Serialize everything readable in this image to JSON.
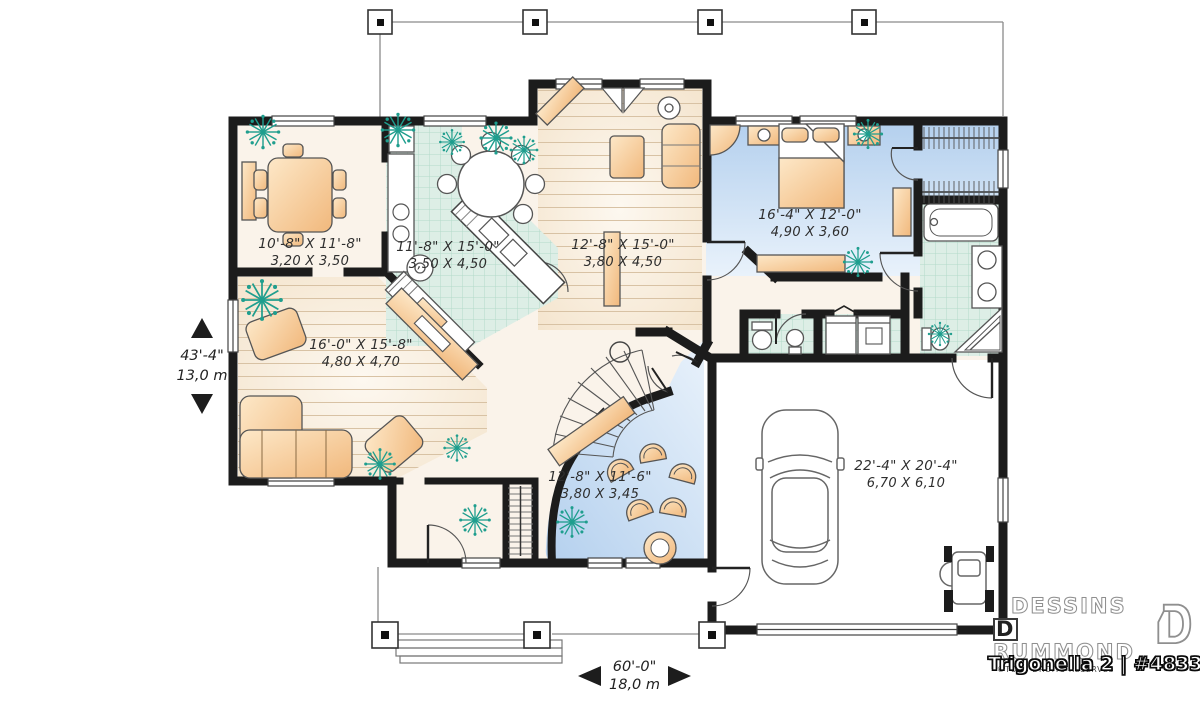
{
  "brand": {
    "line1": "DESSINS",
    "line2_initial": "D",
    "line2_rest": "RUMMOND",
    "copyright": "©TOUS DROITS RÉSERVÉS",
    "plan_title": "Trigonella 2 | #4833"
  },
  "overall_dimensions": {
    "width_imperial": "60'-0\"",
    "width_metric": "18,0 m",
    "depth_imperial": "43'-4\"",
    "depth_metric": "13,0 m"
  },
  "rooms": [
    {
      "id": "dining-room",
      "imperial": "10'-8\" X 11'-8\"",
      "metric": "3,20 X 3,50"
    },
    {
      "id": "kitchen",
      "imperial": "11'-8\" X 15'-0\"",
      "metric": "3,50 X 4,50"
    },
    {
      "id": "living-room",
      "imperial": "12'-8\" X 15'-0\"",
      "metric": "3,80 X 4,50"
    },
    {
      "id": "master-bedroom",
      "imperial": "16'-4\" X 12'-0\"",
      "metric": "4,90 X 3,60"
    },
    {
      "id": "great-room",
      "imperial": "16'-0\" X 15'-8\"",
      "metric": "4,80 X 4,70"
    },
    {
      "id": "family-room",
      "imperial": "12'-8\" X 11'-6\"",
      "metric": "3,80 X 3,45"
    },
    {
      "id": "garage",
      "imperial": "22'-4\" X 20'-4\"",
      "metric": "6,70 X 6,10"
    }
  ],
  "colors": {
    "wall": "#1c1c1c",
    "wood_floor": "#f4e8d4",
    "tile_floor": "#daeee4",
    "blue_floor": "#bdd5ef",
    "furniture": "#f7c98e",
    "plant": "#1f9e8e"
  }
}
